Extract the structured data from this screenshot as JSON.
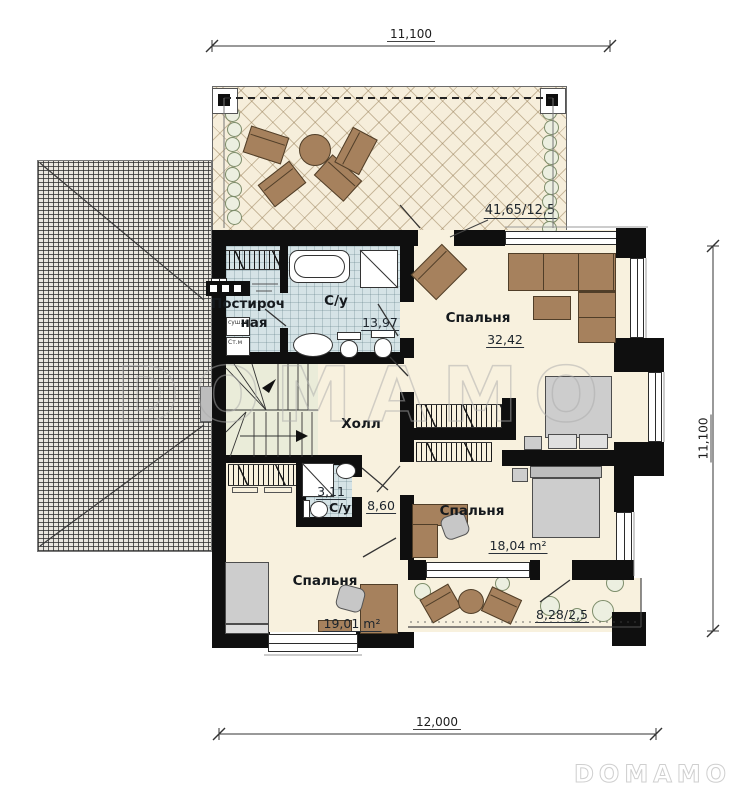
{
  "dimensions": {
    "top": "11,100",
    "right": "11,100",
    "bottom": "12,000"
  },
  "rooms": {
    "laundry": {
      "name_line1": "Постироч",
      "name_line2": "ная"
    },
    "bathroom_main": {
      "name": "С/у",
      "area": "13,97"
    },
    "bathroom_small": {
      "name": "С/у",
      "area": "3,11"
    },
    "hall": {
      "name": "Холл",
      "area": "8,60"
    },
    "bedroom_large": {
      "name": "Спальня",
      "area": "32,42"
    },
    "bedroom_right": {
      "name": "Спальня",
      "area": "18,04 m²"
    },
    "bedroom_left": {
      "name": "Спальня",
      "area": "19,01 m²"
    },
    "terrace": {
      "area": "41,65/12,5"
    },
    "balcony": {
      "area": "8,28/2,5"
    }
  },
  "appliances": {
    "dryer": "суш.м",
    "washer": "Ст.м"
  },
  "watermark": {
    "large": "DOMAMO",
    "small": "DOMAMO"
  },
  "colors": {
    "wall": "#0f0f0f",
    "floor": "#f8f1de",
    "tile": "#d5e3e6",
    "stairs": "#eaecd9",
    "furniture": "#a6815d",
    "terrace_floor": "#f6eedb"
  }
}
